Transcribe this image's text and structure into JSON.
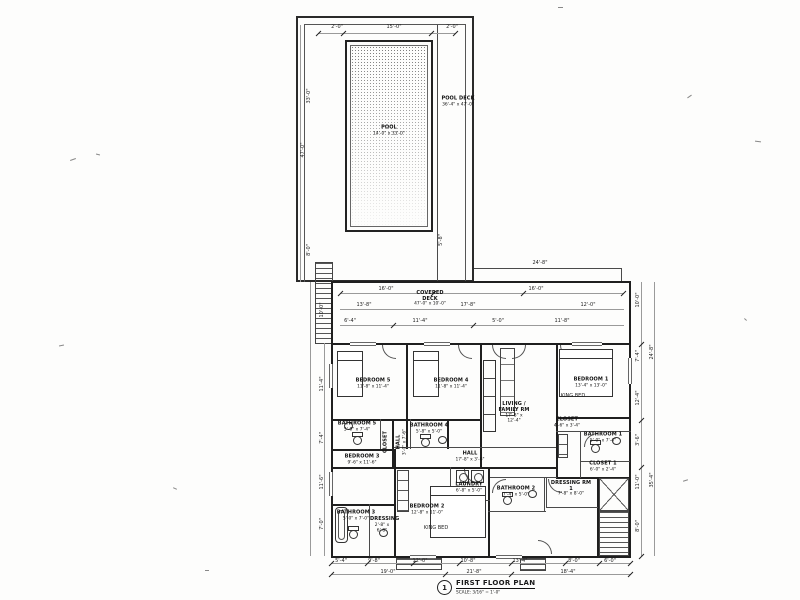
{
  "sheet": {
    "title_block": {
      "number": "1",
      "title": "FIRST FLOOR PLAN",
      "scale": "SCALE: 3/16\" = 1'-0\""
    },
    "pool": {
      "name": "POOL",
      "dims": "14'-0\" x 33'-0\""
    },
    "pool_deck": {
      "name": "POOL DECK",
      "dims": "36'-4\" x 47'-0\""
    },
    "covered_deck": {
      "name": "COVERED DECK",
      "dims": "47'-0\" x 10'-0\""
    },
    "rooms": [
      {
        "name": "BEDROOM 5",
        "dims": "11'-8\" x 11'-4\""
      },
      {
        "name": "BEDROOM 4",
        "dims": "11'-8\" x 11'-4\""
      },
      {
        "name": "LIVING / FAMILY RM",
        "dims": "17'-8\" x 12'-4\""
      },
      {
        "name": "BEDROOM 1",
        "dims": "13'-4\" x 13'-0\""
      },
      {
        "name": "CLOSET",
        "dims": "4'-6\" x 3'-4\""
      },
      {
        "name": "BATHROOM 1",
        "dims": "5'-0\" x 7'-4\""
      },
      {
        "name": "CLOSET 1",
        "dims": "6'-0\" x 2'-4\""
      },
      {
        "name": "DRESSING RM 1",
        "dims": "7'-8\" x 8'-0\""
      },
      {
        "name": "BATHROOM 5",
        "dims": "5'-0\" x 7'-4\""
      },
      {
        "name": "HALL",
        "dims": "3'-0\" x 7'-6\""
      },
      {
        "name": "CLOSET",
        "dims": ""
      },
      {
        "name": "BATHROOM 4",
        "dims": "5'-8\" x 5'-0\""
      },
      {
        "name": "HALL",
        "dims": "17'-8\" x 3'-6\""
      },
      {
        "name": "BEDROOM 3",
        "dims": "9'-6\" x 11'-6\""
      },
      {
        "name": "BATHROOM 3",
        "dims": "5'-0\" x 7'-0\""
      },
      {
        "name": "DRESSING",
        "dims": "2'-8\" x 6'-8\""
      },
      {
        "name": "BEDROOM 2",
        "dims": "12'-8\" x 11'-0\""
      },
      {
        "name": "LAUNDRY",
        "dims": "6'-8\" x 5'-0\""
      },
      {
        "name": "BATHROOM 2",
        "dims": "7'-4\" x 5'-0\""
      }
    ],
    "dims": [
      "2'-0\"",
      "15'-0\"",
      "2'-0\"",
      "5'-8\"",
      "47'-0\"",
      "33'-0\"",
      "8'-0\"",
      "16'-0\"",
      "16'-0\"",
      "13'-8\"",
      "17'-8\"",
      "12'-0\"",
      "6'-4\"",
      "11'-4\"",
      "5'-0\"",
      "11'-8\"",
      "24'-8\"",
      "10'-0\"",
      "7'-4\"",
      "12'-4\"",
      "3'-6\"",
      "11'-0\"",
      "8'-0\"",
      "24'-8\"",
      "35'-4\"",
      "10'-0\"",
      "11'-4\"",
      "7'-4\"",
      "11'-6\"",
      "7'-0\"",
      "5'-4\"",
      "9'-8\"",
      "12'-0\"",
      "10'-8\"",
      "13'-4\"",
      "8'-0\"",
      "6'-0\"",
      "19'-0\"",
      "21'-8\"",
      "18'-4\"",
      "KING BED",
      "KING BED"
    ]
  }
}
